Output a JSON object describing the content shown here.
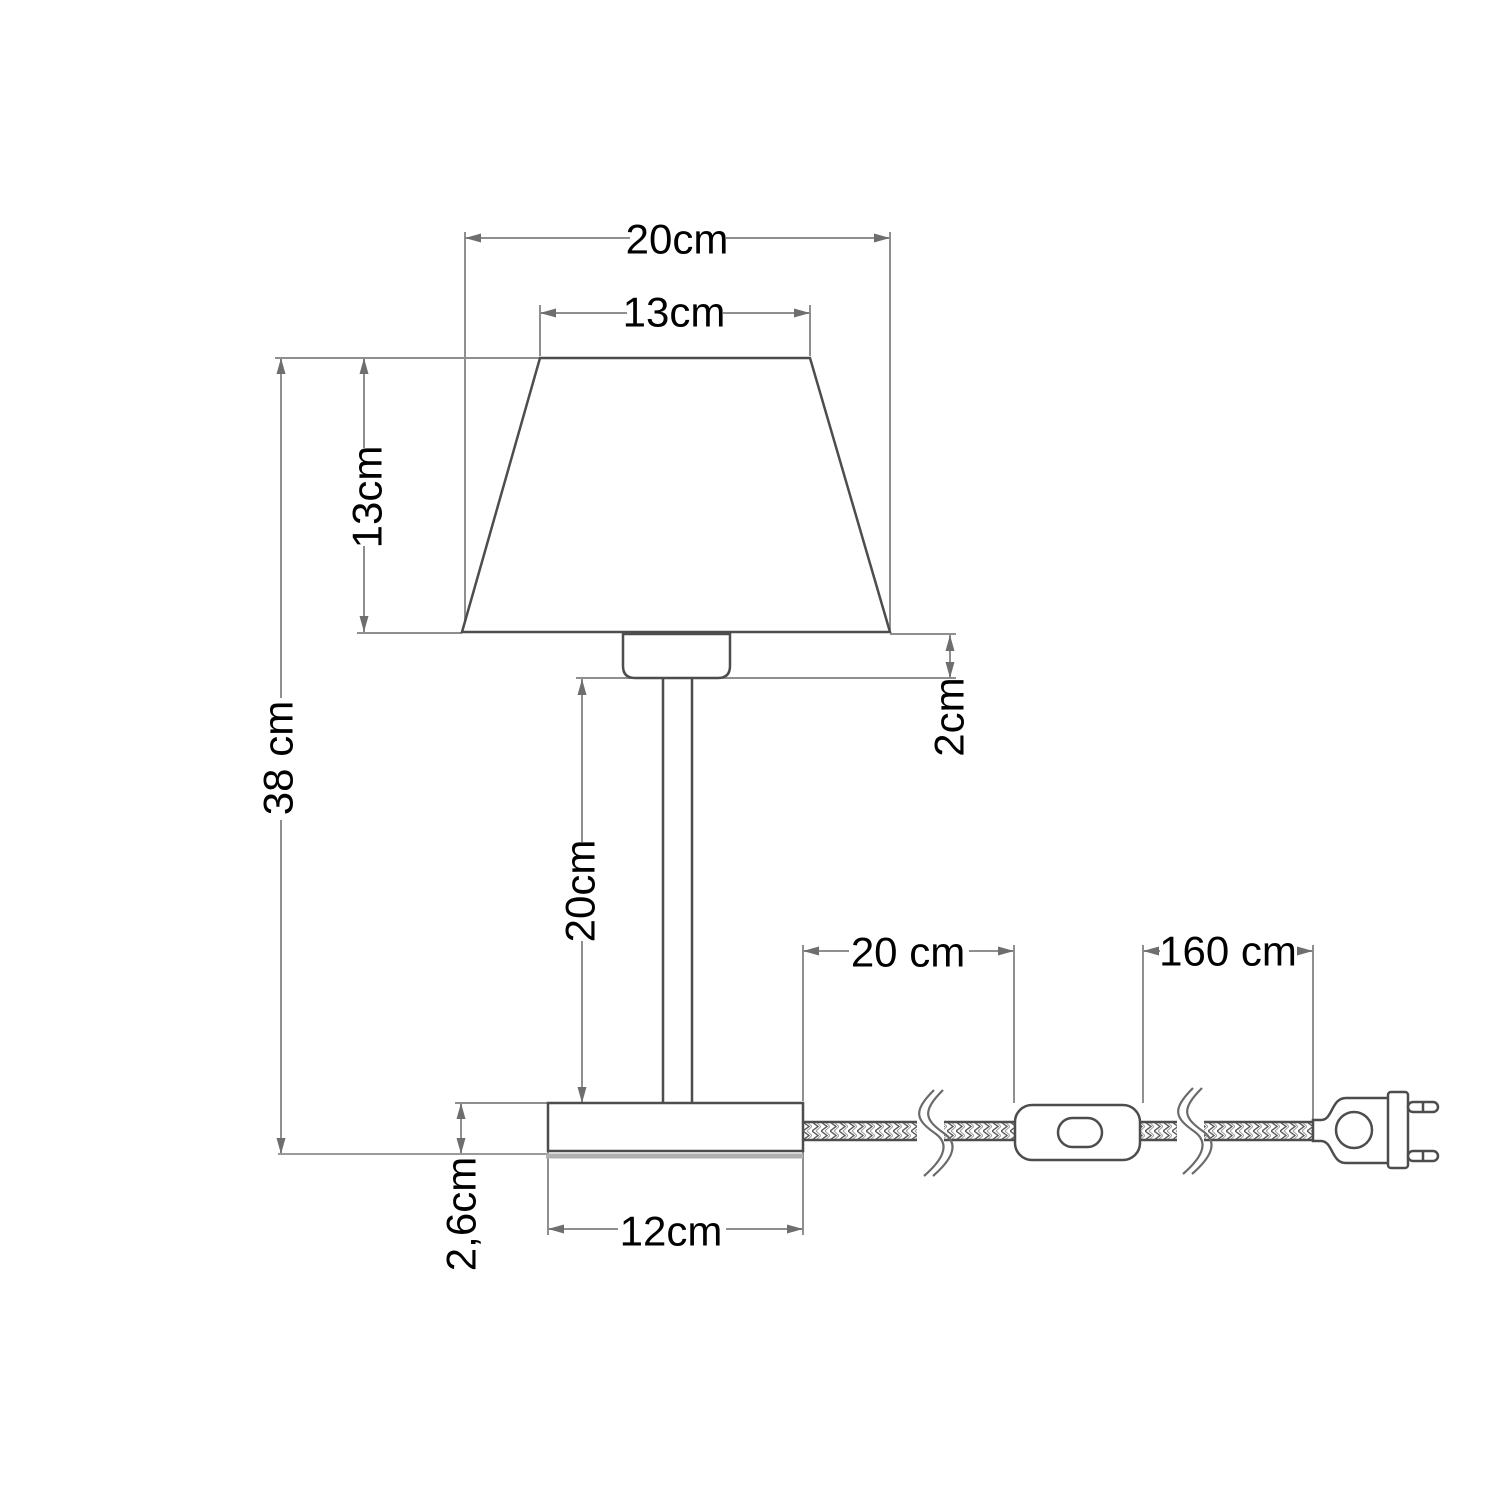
{
  "title": "Table lamp technical dimension drawing",
  "colors": {
    "background": "#ffffff",
    "body_line": "#4d4d4d",
    "dimension_line": "#8f8f8f",
    "base_ground_line": "#b0b0b0",
    "text": "#000000"
  },
  "dimensions": {
    "shade_bottom_diameter": {
      "label": "20cm",
      "measures": "lamp shade bottom width"
    },
    "shade_top_diameter": {
      "label": "13cm",
      "measures": "lamp shade top width"
    },
    "shade_height": {
      "label": "13cm",
      "measures": "lamp shade height"
    },
    "total_height": {
      "label": "38 cm",
      "measures": "total lamp height"
    },
    "socket_height": {
      "label": "2cm",
      "measures": "socket height below shade"
    },
    "stem_height": {
      "label": "20cm",
      "measures": "stem height"
    },
    "base_height": {
      "label": "2,6cm",
      "measures": "base height"
    },
    "base_width": {
      "label": "12cm",
      "measures": "base width"
    },
    "cord_base_to_switch": {
      "label": "20 cm",
      "measures": "cord length from base to switch"
    },
    "cord_switch_to_plug": {
      "label": "160 cm",
      "measures": "cord length from switch to plug"
    }
  },
  "parts": [
    "lamp shade",
    "lamp socket",
    "stem",
    "base",
    "braided power cord",
    "inline switch",
    "euro plug"
  ]
}
